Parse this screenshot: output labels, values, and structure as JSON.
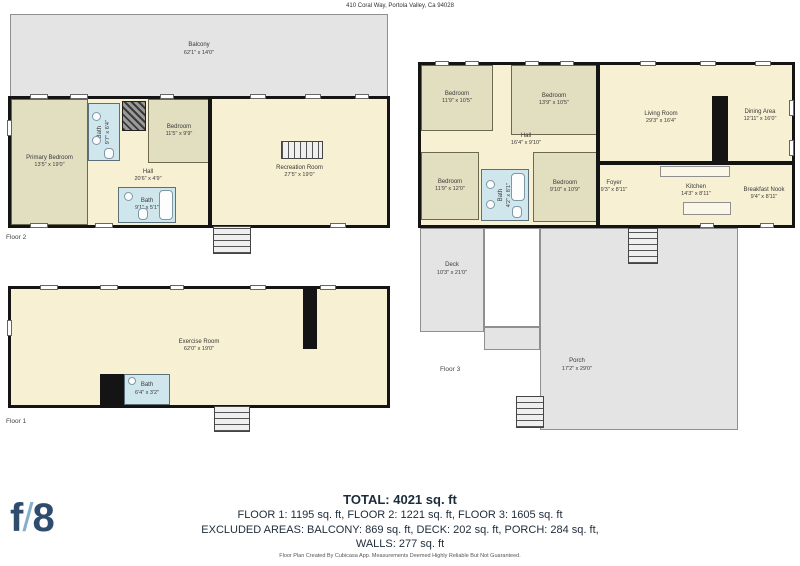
{
  "header": {
    "address": "410 Coral Way, Portola Valley, Ca 94028"
  },
  "colors": {
    "wall": "#141414",
    "cream": "#f7f0d2",
    "sage": "#e2dfc1",
    "bathblue": "#cfe6ec",
    "outdoor": "#e4e4e4",
    "outdoor_border": "#8f8f8f",
    "label": "#3a3a3a",
    "summary_text": "#1d2b3a",
    "logo_navy": "#2e4d6e",
    "logo_slash": "#85aecb"
  },
  "floor2": {
    "label": "Floor 2",
    "outdoor": {
      "balcony": {
        "name": "Balcony",
        "dims": "62'1\" x 14'0\""
      }
    },
    "rooms": [
      {
        "name": "Primary Bedroom",
        "dims": "13'5\" x 19'0\""
      },
      {
        "name": "Bath",
        "dims": "9'7\" x 6'4\""
      },
      {
        "name": "Bedroom",
        "dims": "11'5\" x 9'9\""
      },
      {
        "name": "Hall",
        "dims": "20'6\" x 4'9\""
      },
      {
        "name": "Bath",
        "dims": "9'1\" x 5'1\""
      },
      {
        "name": "Recreation Room",
        "dims": "27'5\" x 19'0\""
      }
    ]
  },
  "floor3": {
    "label": "Floor 3",
    "outdoor": {
      "deck": {
        "name": "Deck",
        "dims": "10'3\" x 21'0\""
      },
      "porch": {
        "name": "Porch",
        "dims": "17'2\" x 29'0\""
      }
    },
    "rooms": [
      {
        "name": "Bedroom",
        "dims": "11'9\" x 10'5\""
      },
      {
        "name": "Bedroom",
        "dims": "13'9\" x 10'5\""
      },
      {
        "name": "Hall",
        "dims": "16'4\" x 9'10\""
      },
      {
        "name": "Bedroom",
        "dims": "11'9\" x 12'0\""
      },
      {
        "name": "Bath",
        "dims": "4'2\" x 8'1\""
      },
      {
        "name": "Bedroom",
        "dims": "9'10\" x 10'9\""
      },
      {
        "name": "Living Room",
        "dims": "29'3\" x 16'4\""
      },
      {
        "name": "Dining Area",
        "dims": "12'11\" x 16'0\""
      },
      {
        "name": "Foyer",
        "dims": "9'3\" x 8'11\""
      },
      {
        "name": "Kitchen",
        "dims": "14'3\" x 8'11\""
      },
      {
        "name": "Breakfast Nook",
        "dims": "9'4\" x 8'11\""
      }
    ]
  },
  "floor1": {
    "label": "Floor 1",
    "rooms": [
      {
        "name": "Exercise Room",
        "dims": "62'0\" x 19'0\""
      },
      {
        "name": "Bath",
        "dims": "6'4\" x 3'2\""
      }
    ]
  },
  "summary": {
    "total": "TOTAL: 4021 sq. ft",
    "floors": "FLOOR 1: 1195 sq. ft, FLOOR 2: 1221 sq. ft, FLOOR 3: 1605 sq. ft",
    "excluded": "EXCLUDED AREAS: BALCONY: 869 sq. ft, DECK: 202 sq. ft, PORCH: 284 sq. ft,",
    "walls": "WALLS: 277 sq. ft"
  },
  "footer": {
    "credit": "Floor Plan Created By Cubicasa App. Measurements Deemed Highly Reliable But Not Guaranteed."
  },
  "logo": {
    "f": "f",
    "slash": "/",
    "eight": "8"
  }
}
